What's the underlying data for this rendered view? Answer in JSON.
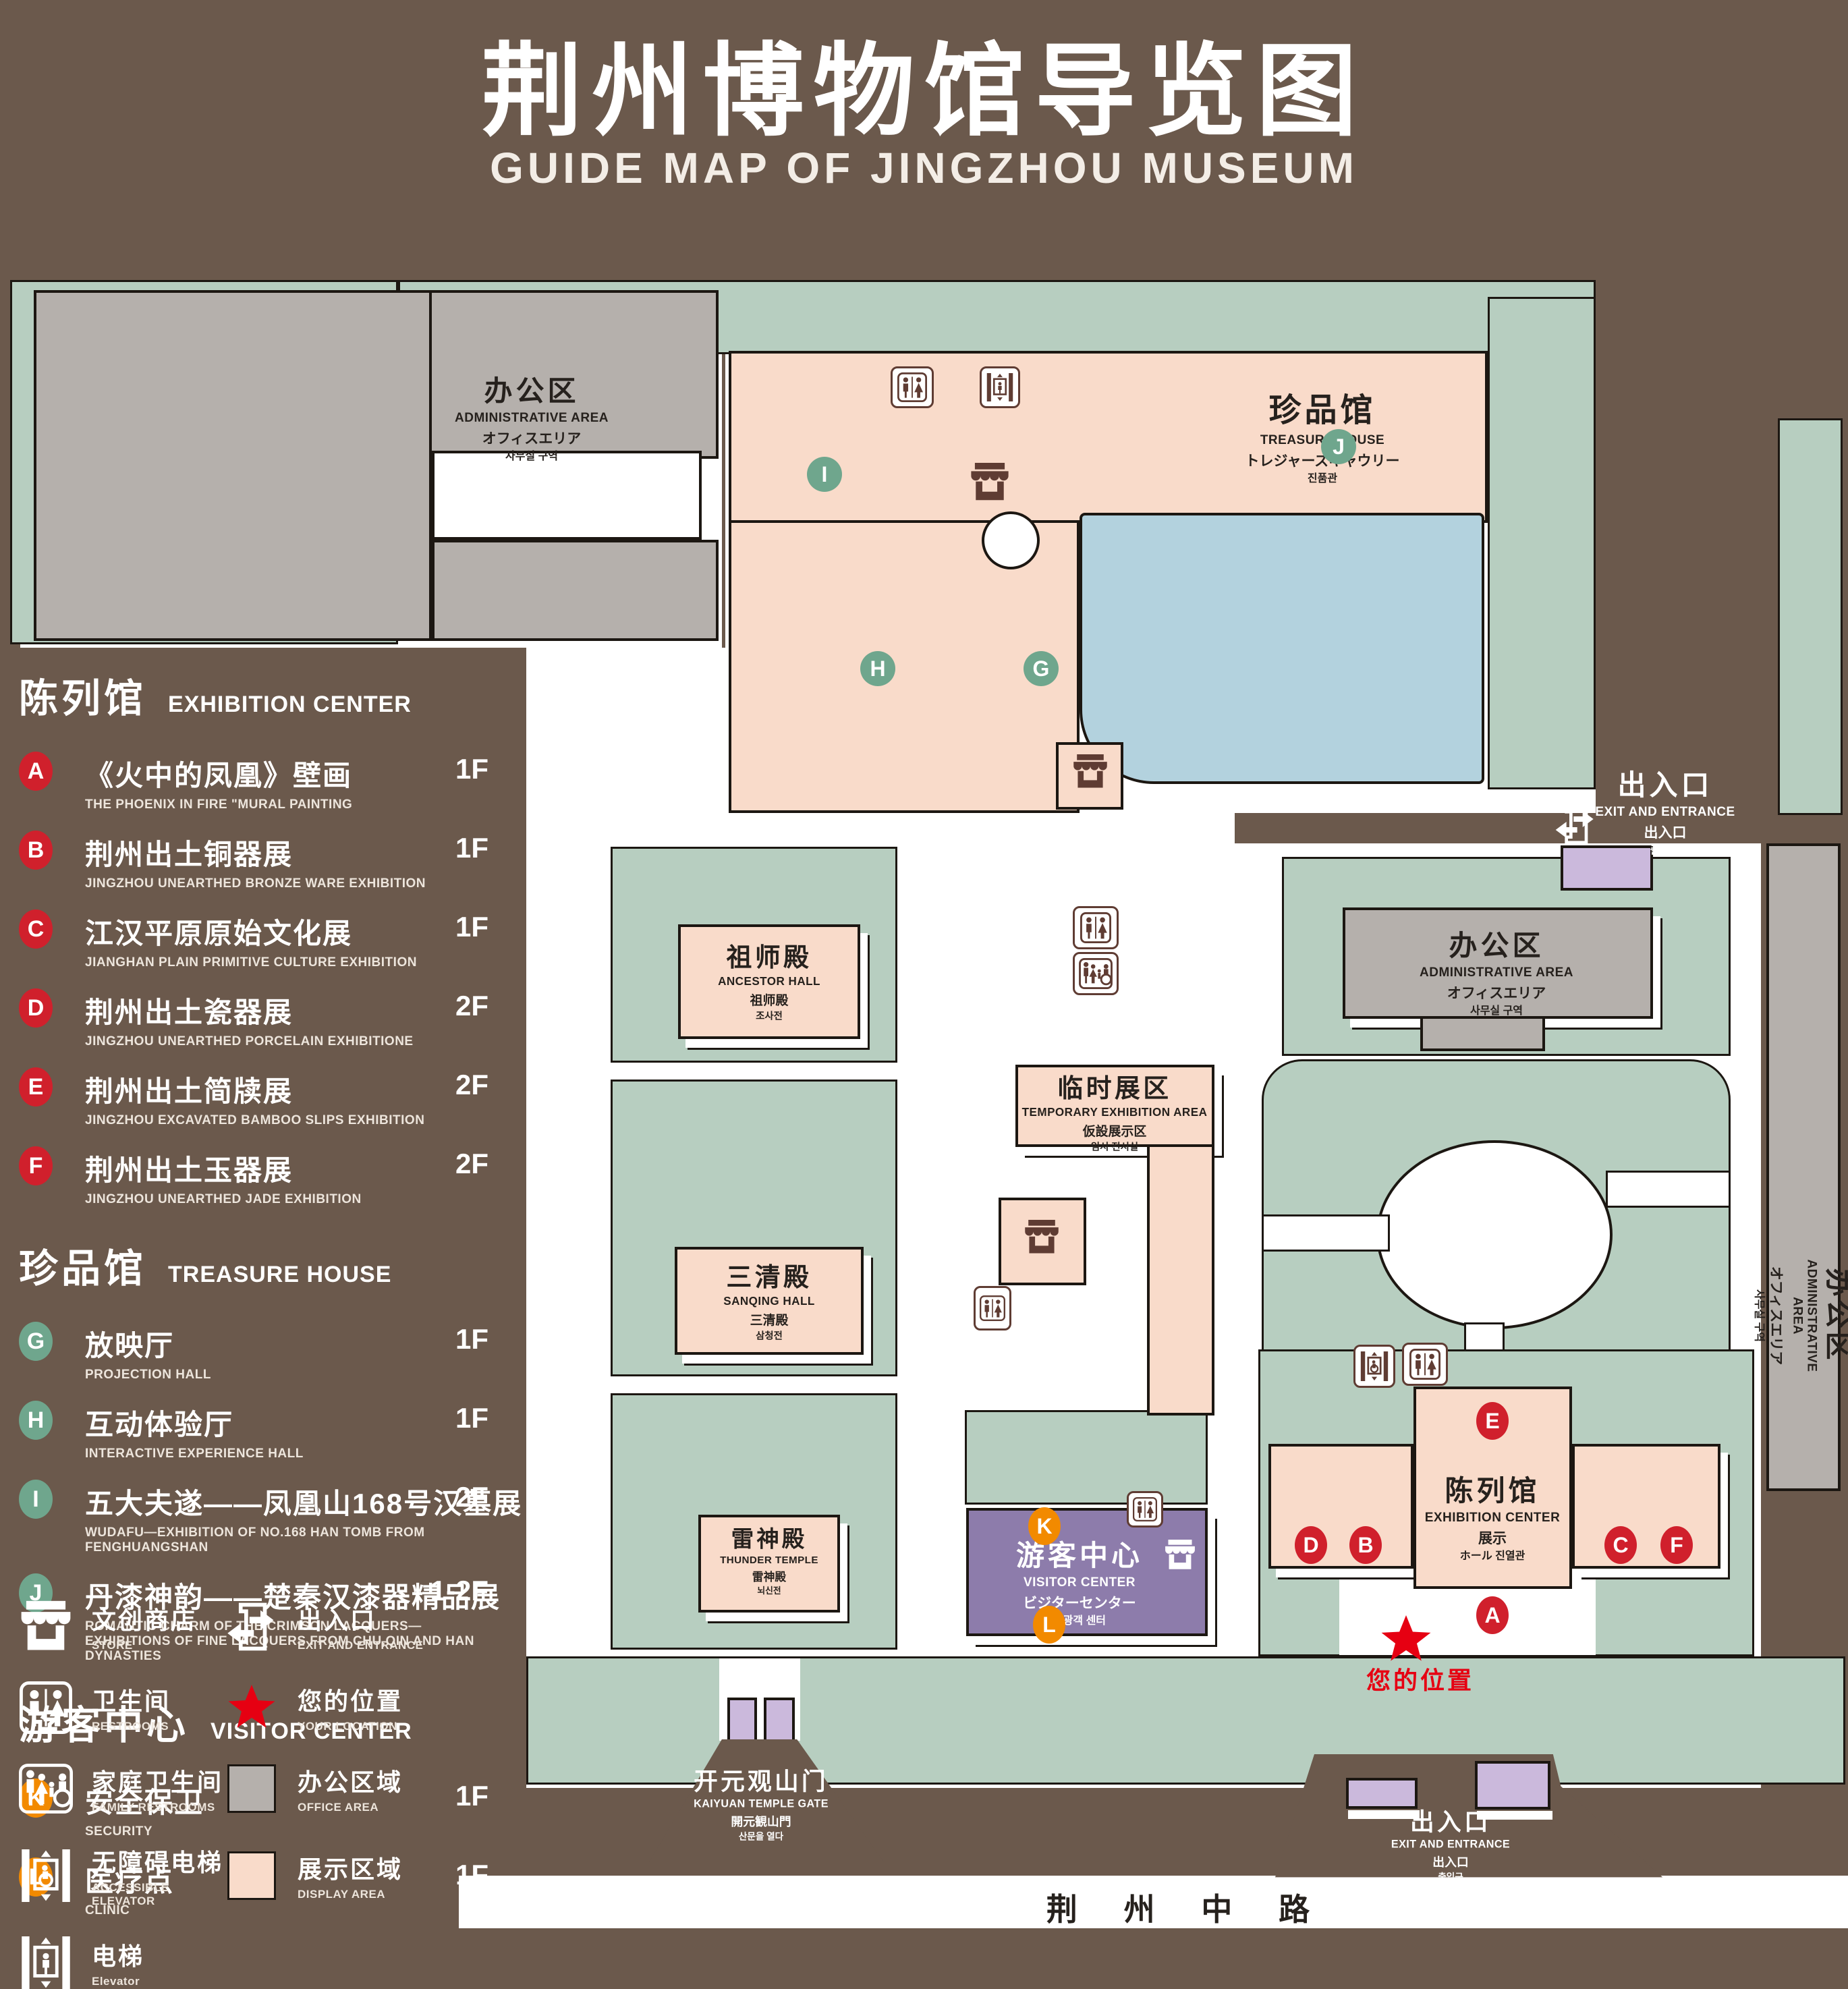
{
  "title": {
    "zh": "荆州博物馆导览图",
    "en": "GUIDE MAP OF JINGZHOU MUSEUM"
  },
  "colors": {
    "background": "#6B594C",
    "lawn": "#B7CEC0",
    "display_area": "#F9DBCA",
    "office_area": "#B5B0AC",
    "pond": "#B3D2DE",
    "visitor_center": "#8D7CAB",
    "gate_building": "#CBB9DC",
    "marker_red": "#D0202C",
    "marker_green": "#6FA68D",
    "marker_orange": "#F28A00",
    "icon_brown": "#5F3C33",
    "location_red": "#E60012"
  },
  "legend": {
    "sections": [
      {
        "zh": "陈列馆",
        "en": "EXHIBITION CENTER",
        "badge_color": "#D0202C",
        "items": [
          {
            "id": "A",
            "zh": "《火中的凤凰》壁画",
            "en": "THE PHOENIX IN FIRE \"MURAL PAINTING",
            "floor": "1F"
          },
          {
            "id": "B",
            "zh": "荆州出土铜器展",
            "en": "JINGZHOU UNEARTHED BRONZE WARE EXHIBITION",
            "floor": "1F"
          },
          {
            "id": "C",
            "zh": "江汉平原原始文化展",
            "en": "JIANGHAN PLAIN PRIMITIVE CULTURE EXHIBITION",
            "floor": "1F"
          },
          {
            "id": "D",
            "zh": "荆州出土瓷器展",
            "en": "JINGZHOU UNEARTHED PORCELAIN EXHIBITIONE",
            "floor": "2F"
          },
          {
            "id": "E",
            "zh": "荆州出土简牍展",
            "en": "JINGZHOU EXCAVATED BAMBOO SLIPS EXHIBITION",
            "floor": "2F"
          },
          {
            "id": "F",
            "zh": "荆州出土玉器展",
            "en": "JINGZHOU UNEARTHED JADE EXHIBITION",
            "floor": "2F"
          }
        ]
      },
      {
        "zh": "珍品馆",
        "en": "TREASURE HOUSE",
        "badge_color": "#6FA68D",
        "items": [
          {
            "id": "G",
            "zh": "放映厅",
            "en": "PROJECTION HALL",
            "floor": "1F"
          },
          {
            "id": "H",
            "zh": "互动体验厅",
            "en": "INTERACTIVE EXPERIENCE HALL",
            "floor": "1F"
          },
          {
            "id": "I",
            "zh": "五大夫遂——凤凰山168号汉墓展",
            "en": "WUDAFU—EXHIBITION OF NO.168 HAN TOMB FROM FENGHUANGSHAN",
            "floor": "2F"
          },
          {
            "id": "J",
            "zh": "丹漆神韵——楚秦汉漆器精品展",
            "en": "ROMANTIC CHARM OF THE CRIMSON LACQUERS—EXHIBITIONS OF FINE LACQUERS FROM CHU,QIN AND HAN DYNASTIES",
            "floor": "1-2F"
          }
        ]
      },
      {
        "zh": "游客中心",
        "en": "VISITOR CENTER",
        "badge_color": "#F28A00",
        "items": [
          {
            "id": "K",
            "zh": "安全保卫",
            "en": "SECURITY",
            "floor": "1F"
          },
          {
            "id": "L",
            "zh": "医疗点",
            "en": "CLINIC",
            "floor": "1F"
          }
        ]
      }
    ],
    "symbols": [
      {
        "icon": "store-icon",
        "zh": "文创商店",
        "en": "STORE"
      },
      {
        "icon": "exit-icon",
        "zh": "出入口",
        "en": "EXIT AND ENTRANCE"
      },
      {
        "icon": "restroom-icon",
        "zh": "卫生间",
        "en": "RESTROOMS"
      },
      {
        "icon": "location-star-icon",
        "zh": "您的位置",
        "en": "YOUR LOCATION"
      },
      {
        "icon": "family-restroom-icon",
        "zh": "家庭卫生间",
        "en": "FAMILY RESTROOMS"
      },
      {
        "icon": "office-area-swatch",
        "zh": "办公区域",
        "en": "OFFICE AREA"
      },
      {
        "icon": "accessible-elevator-icon",
        "zh": "无障碍电梯",
        "en": "ACCESSIBLE ELEVATOR"
      },
      {
        "icon": "display-area-swatch",
        "zh": "展示区域",
        "en": "DISPLAY AREA"
      },
      {
        "icon": "elevator-icon",
        "zh": "电梯",
        "en": "Elevator"
      }
    ]
  },
  "map": {
    "buildings": {
      "admin_nw": {
        "zh": "办公区",
        "en": "ADMINISTRATIVE AREA",
        "jp": "オフィスエリア",
        "kr": "사무실 구역"
      },
      "treasure_house": {
        "zh": "珍品馆",
        "en": "TREASURE HOUSE",
        "jp": "トレジャーズギャウリー",
        "kr": "진품관"
      },
      "exit_right": {
        "zh": "出入口",
        "en": "EXIT AND ENTRANCE",
        "jp": "出入口",
        "kr": "출입구"
      },
      "admin_mid": {
        "zh": "办公区",
        "en": "ADMINISTRATIVE AREA",
        "jp": "オフィスエリア",
        "kr": "사무실 구역"
      },
      "admin_east": {
        "zh": "办公区",
        "en": "ADMINISTRATIVE AREA",
        "jp": "オフィスエリア",
        "kr": "사무실 구역"
      },
      "ancestor_hall": {
        "zh": "祖师殿",
        "en": "ANCESTOR HALL",
        "jp": "祖师殿",
        "kr": "조사전"
      },
      "temporary_exhibition": {
        "zh": "临时展区",
        "en": "TEMPORARY EXHIBITION AREA",
        "jp": "仮設展示区",
        "kr": "임시 전시실"
      },
      "sanqing_hall": {
        "zh": "三清殿",
        "en": "SANQING HALL",
        "jp": "三清殿",
        "kr": "삼청전"
      },
      "thunder_temple": {
        "zh": "雷神殿",
        "en": "THUNDER TEMPLE",
        "jp": "雷神殿",
        "kr": "뇌신전"
      },
      "visitor_center": {
        "zh": "游客中心",
        "en": "VISITOR CENTER",
        "jp": "ビジターセンター",
        "kr": "관광객 센터"
      },
      "exhibition_center": {
        "zh": "陈列馆",
        "en": "EXHIBITION CENTER",
        "jp": "展示",
        "kr": "ホール 진열관"
      },
      "kaiyuan_gate": {
        "zh": "开元观山门",
        "en": "KAIYUAN TEMPLE GATE",
        "jp": "開元観山門",
        "kr": "산문을 열다"
      },
      "exit_bottom": {
        "zh": "出入口",
        "en": "EXIT AND ENTRANCE",
        "jp": "出入口",
        "kr": "출입구"
      }
    },
    "markers": {
      "A": "A",
      "B": "B",
      "C": "C",
      "D": "D",
      "E": "E",
      "F": "F",
      "G": "G",
      "H": "H",
      "I": "I",
      "J": "J",
      "K": "K",
      "L": "L"
    },
    "your_location": "您的位置",
    "road": "荆 州 中 路"
  }
}
